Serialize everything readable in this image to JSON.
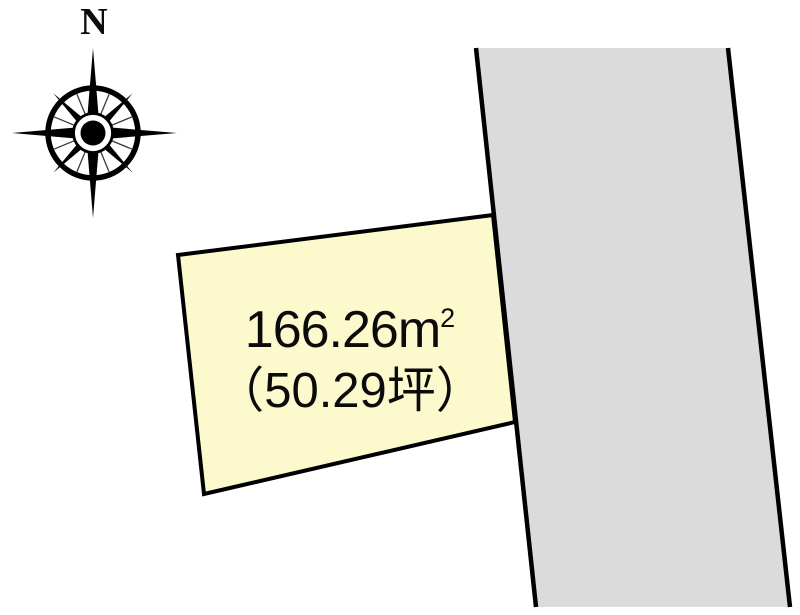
{
  "page": {
    "background_color": "#FFFFFF"
  },
  "compass": {
    "north_label": "N"
  },
  "plot": {
    "area_sqm": "166.26",
    "area_sqm_unit": "m",
    "area_sqm_exponent": "2",
    "area_tsubo": "（50.29坪）",
    "fill_color": "#FCF9CD",
    "outline_color": "#000000"
  },
  "road": {
    "fill_color": "#DBDBDB",
    "edge_color": "#000000"
  }
}
